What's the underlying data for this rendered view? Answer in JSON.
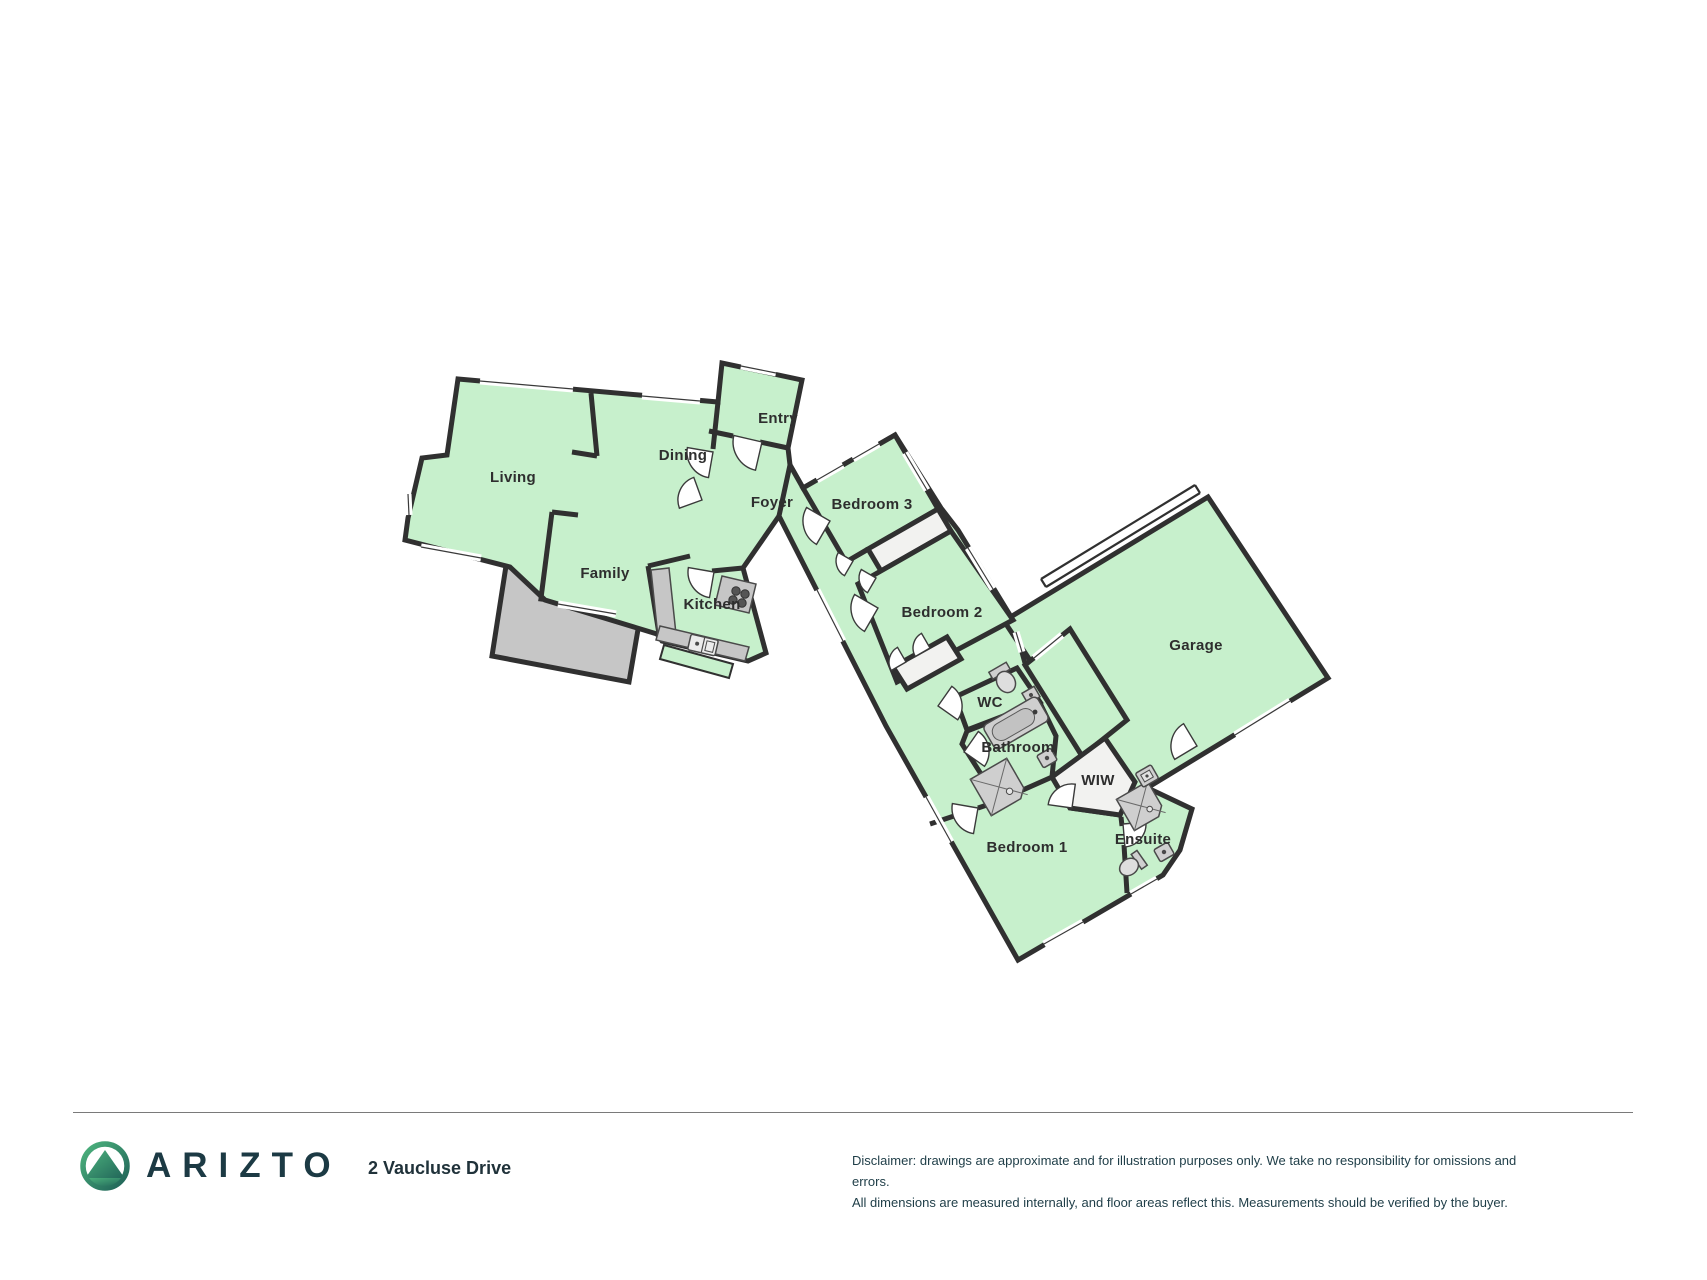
{
  "floorplan": {
    "rooms": [
      {
        "id": "living",
        "label": "Living"
      },
      {
        "id": "dining",
        "label": "Dining"
      },
      {
        "id": "entry",
        "label": "Entry"
      },
      {
        "id": "foyer",
        "label": "Foyer"
      },
      {
        "id": "family",
        "label": "Family"
      },
      {
        "id": "kitchen",
        "label": "Kitchen"
      },
      {
        "id": "bedroom3",
        "label": "Bedroom 3"
      },
      {
        "id": "bedroom2",
        "label": "Bedroom 2"
      },
      {
        "id": "wc",
        "label": "WC"
      },
      {
        "id": "bathroom",
        "label": "Bathroom"
      },
      {
        "id": "wiw",
        "label": "WIW"
      },
      {
        "id": "garage",
        "label": "Garage"
      },
      {
        "id": "bedroom1",
        "label": "Bedroom 1"
      },
      {
        "id": "ensuite",
        "label": "Ensuite"
      }
    ],
    "fixtures": [
      "stove",
      "kitchen-sink",
      "toilet",
      "bathtub",
      "shower",
      "vanity-sink",
      "laundry-tub"
    ],
    "colors": {
      "room_fill": "#c7f0cc",
      "wall": "#303030",
      "deck_fill": "#c6c6c6",
      "closet_fill": "#f2f2f0",
      "fixture_fill": "#cfcfcf",
      "background": "#ffffff"
    }
  },
  "footer": {
    "brand": "ARIZTO",
    "address": "2 Vaucluse Drive",
    "disclaimer_line1": "Disclaimer: drawings are approximate and for illustration purposes only. We take no responsibility for omissions and errors.",
    "disclaimer_line2": "All dimensions are measured internally, and floor areas reflect this. Measurements should be verified by the buyer."
  }
}
